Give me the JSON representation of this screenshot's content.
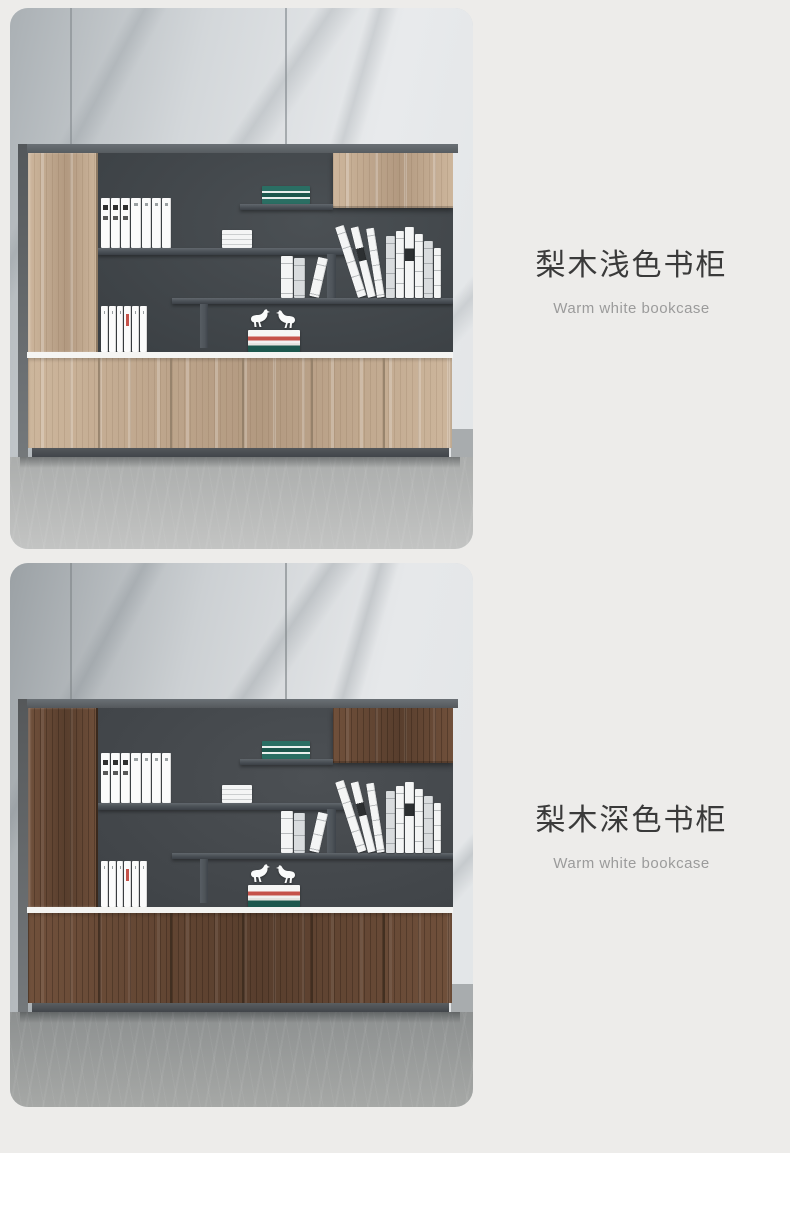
{
  "page": {
    "background": "#edecea",
    "footer_background": "#ffffff"
  },
  "palette": {
    "binder": "#fbfbfb",
    "binder_line": "#d9d9d9",
    "binder_mark": "#2f2f2f",
    "book_white": "#f4f5f5",
    "book_line": "#cbcecf",
    "teal": "#2a6e63",
    "teal_dark": "#1d574d",
    "red": "#c5524a",
    "bird": "#fafbfb"
  },
  "products": [
    {
      "title": "梨木浅色书柜",
      "subtitle": "Warm white bookcase",
      "theme": {
        "wall_a": "#aab0b4",
        "wall_b": "#d3d7da",
        "wall_c": "#e8eaec",
        "seam": "#878d92",
        "vein": "rgba(130,138,144,0.25)",
        "side": "#54585b",
        "band": "#575c60",
        "interior_a": "#4b5054",
        "interior_b": "#3a3f43",
        "shelf": "#4e545a",
        "wood_a": "#cdb69c",
        "wood_b": "#b29980",
        "wood_grain": "rgba(96,70,45,0.12)",
        "wood_sheen": "rgba(255,255,255,0.22)",
        "wood_gap": "#8d7a64",
        "strip": "#f5f5f3",
        "base": "#53575b",
        "floor_a": "#abadac",
        "floor_b": "#c3c4c3"
      }
    },
    {
      "title": "梨木深色书柜",
      "subtitle": "Warm white bookcase",
      "theme": {
        "wall_a": "#9ba1a5",
        "wall_b": "#ccd0d3",
        "wall_c": "#e6e8ea",
        "seam": "#82888c",
        "vein": "rgba(122,130,136,0.28)",
        "side": "#55585a",
        "band": "#54585c",
        "interior_a": "#4c5054",
        "interior_b": "#3e4246",
        "shelf": "#4d5358",
        "wood_a": "#70503b",
        "wood_b": "#583e2d",
        "wood_grain": "rgba(28,16,8,0.28)",
        "wood_sheen": "rgba(255,255,255,0.08)",
        "wood_gap": "#3a291d",
        "strip": "#f4f4f2",
        "base": "#5a5e61",
        "floor_a": "#8d9090",
        "floor_b": "#a6a8a6"
      }
    }
  ]
}
